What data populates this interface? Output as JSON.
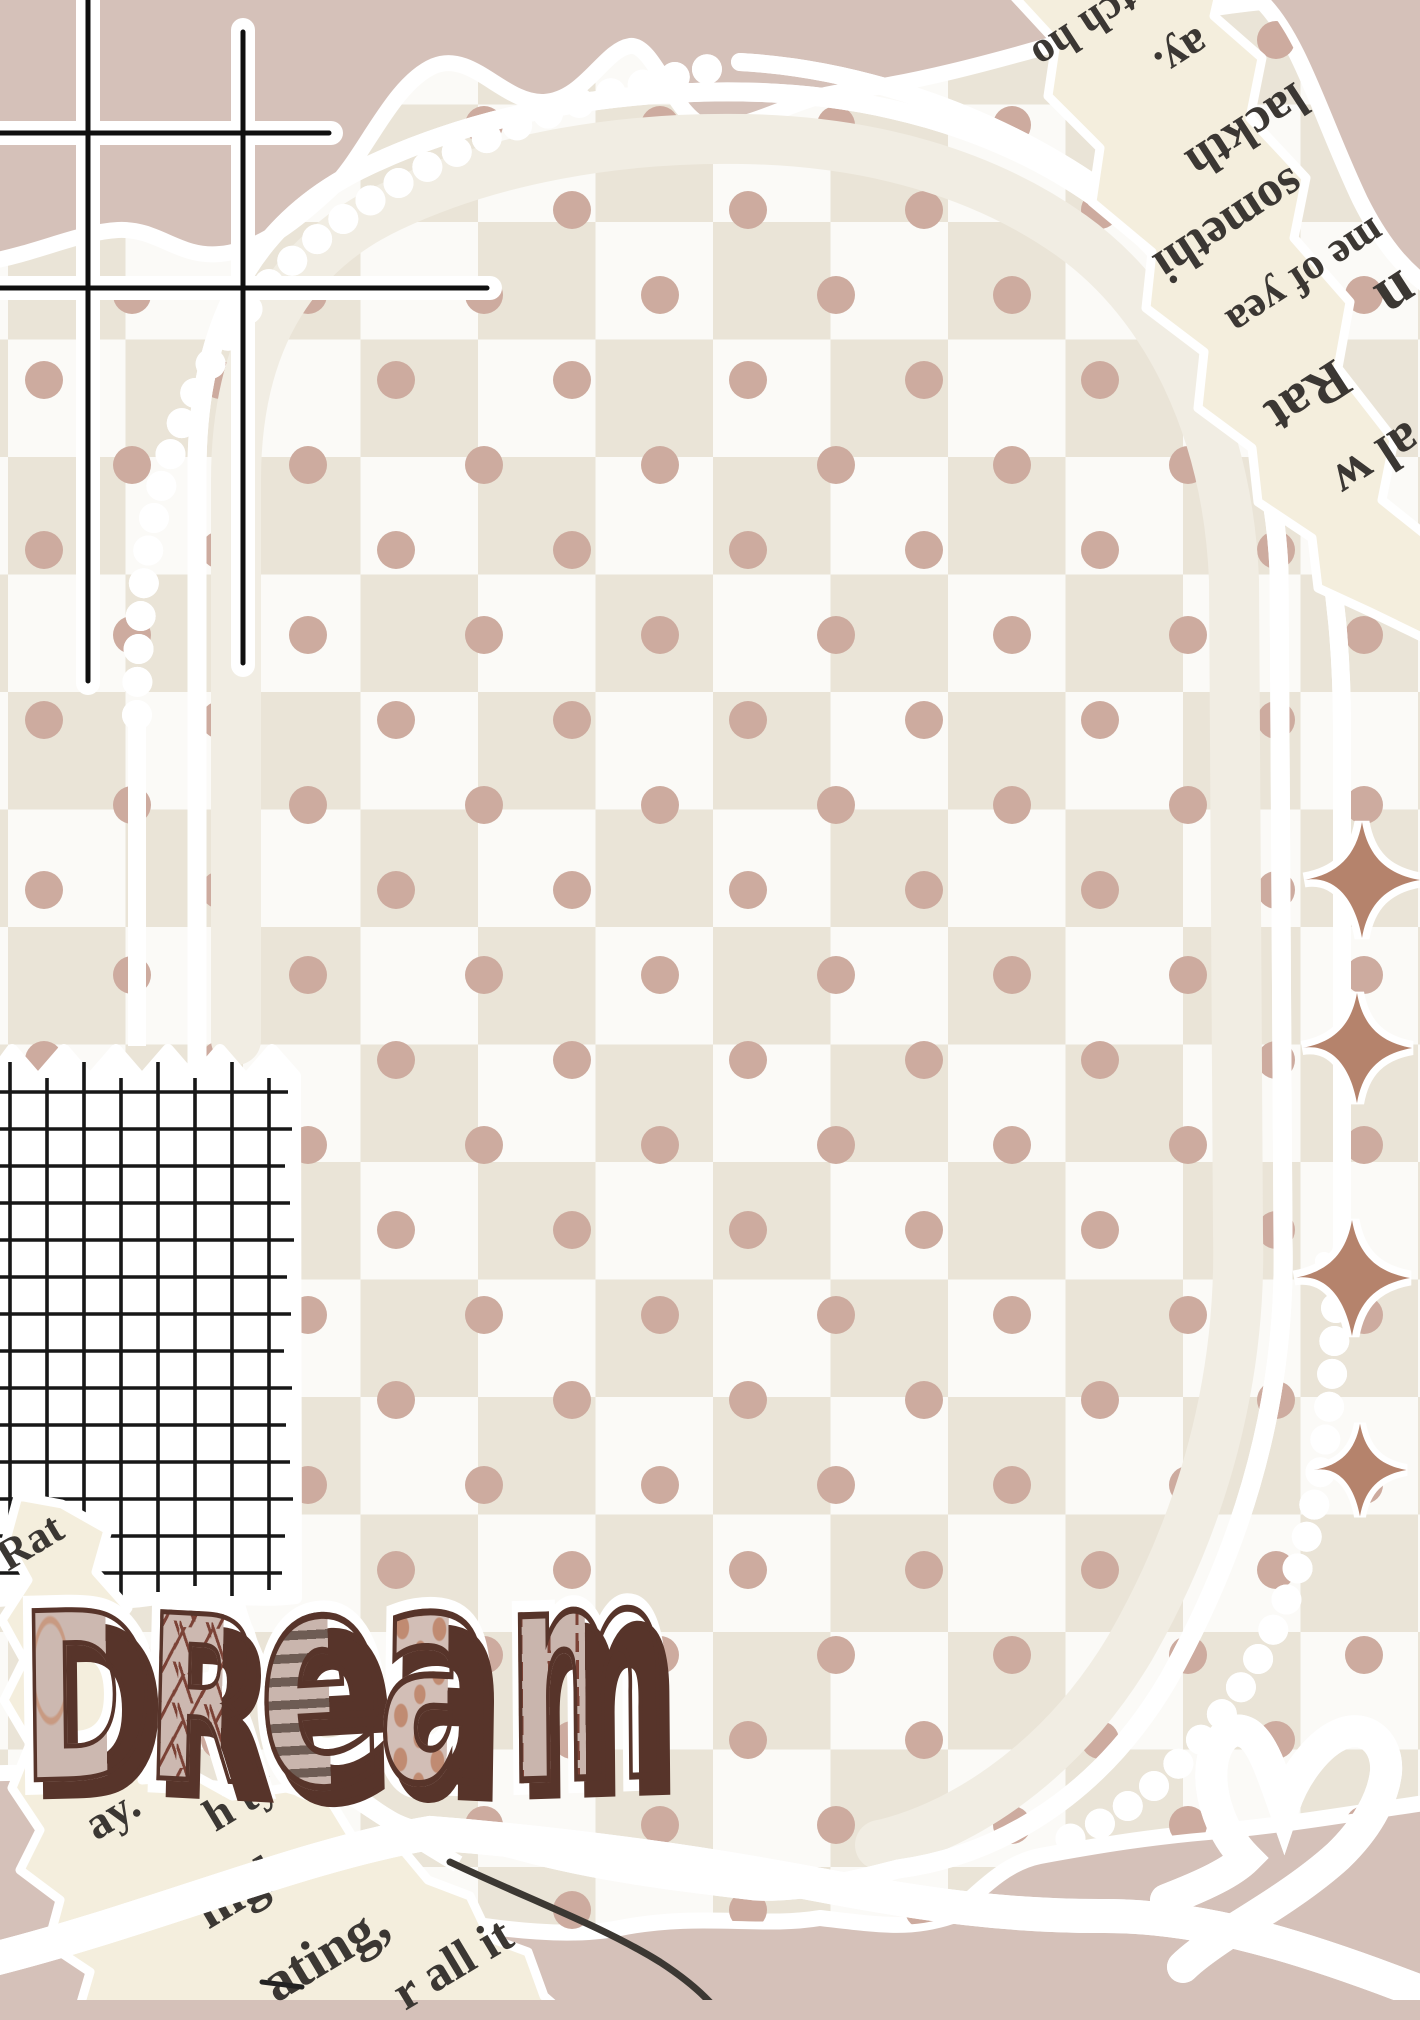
{
  "canvas": {
    "width": 1420,
    "height": 2000
  },
  "palette": {
    "background": "#d5c1b9",
    "checker_cream": "#eae4d7",
    "checker_white": "#fbfaf7",
    "polka_dot": "#cdab9f",
    "ink": "#3c3833",
    "grid_line": "#171717",
    "newsprint_paper": "#f4eedd",
    "newsprint_ink": "#3b3733",
    "tan": "#bd8a74",
    "sparkle": "#b5836c",
    "letter_fill": "#ccb8b0",
    "letter_outline": "#57342a"
  },
  "dream": {
    "label": "DReam",
    "letters": [
      {
        "char": "D",
        "pattern": "solid-with-accent"
      },
      {
        "char": "R",
        "pattern": "sprinkles"
      },
      {
        "char": "e",
        "pattern": "stripes"
      },
      {
        "char": "a",
        "pattern": "polka-dots"
      },
      {
        "char": "m",
        "pattern": "stitches"
      }
    ]
  },
  "newspaper_top_right": {
    "fragments": [
      {
        "text": "tch ho"
      },
      {
        "text": "ay."
      },
      {
        "text": "lackth"
      },
      {
        "text": "somethi"
      },
      {
        "text": "me of yea"
      },
      {
        "text": "n"
      },
      {
        "text": "Rat"
      },
      {
        "text": "al w"
      }
    ]
  },
  "newspaper_bottom_left": {
    "fragments": [
      {
        "text": "Rat"
      },
      {
        "text": "ay."
      },
      {
        "text": "h ty"
      },
      {
        "text": "nigh"
      },
      {
        "text": "ating,"
      },
      {
        "text": "r all it"
      }
    ]
  },
  "decor": {
    "sparkle_count": 4,
    "heart": true,
    "dotted_thread": true,
    "tictactoe_sticker": true,
    "graph_paper_patch": true,
    "checkerboard_paper": true
  }
}
